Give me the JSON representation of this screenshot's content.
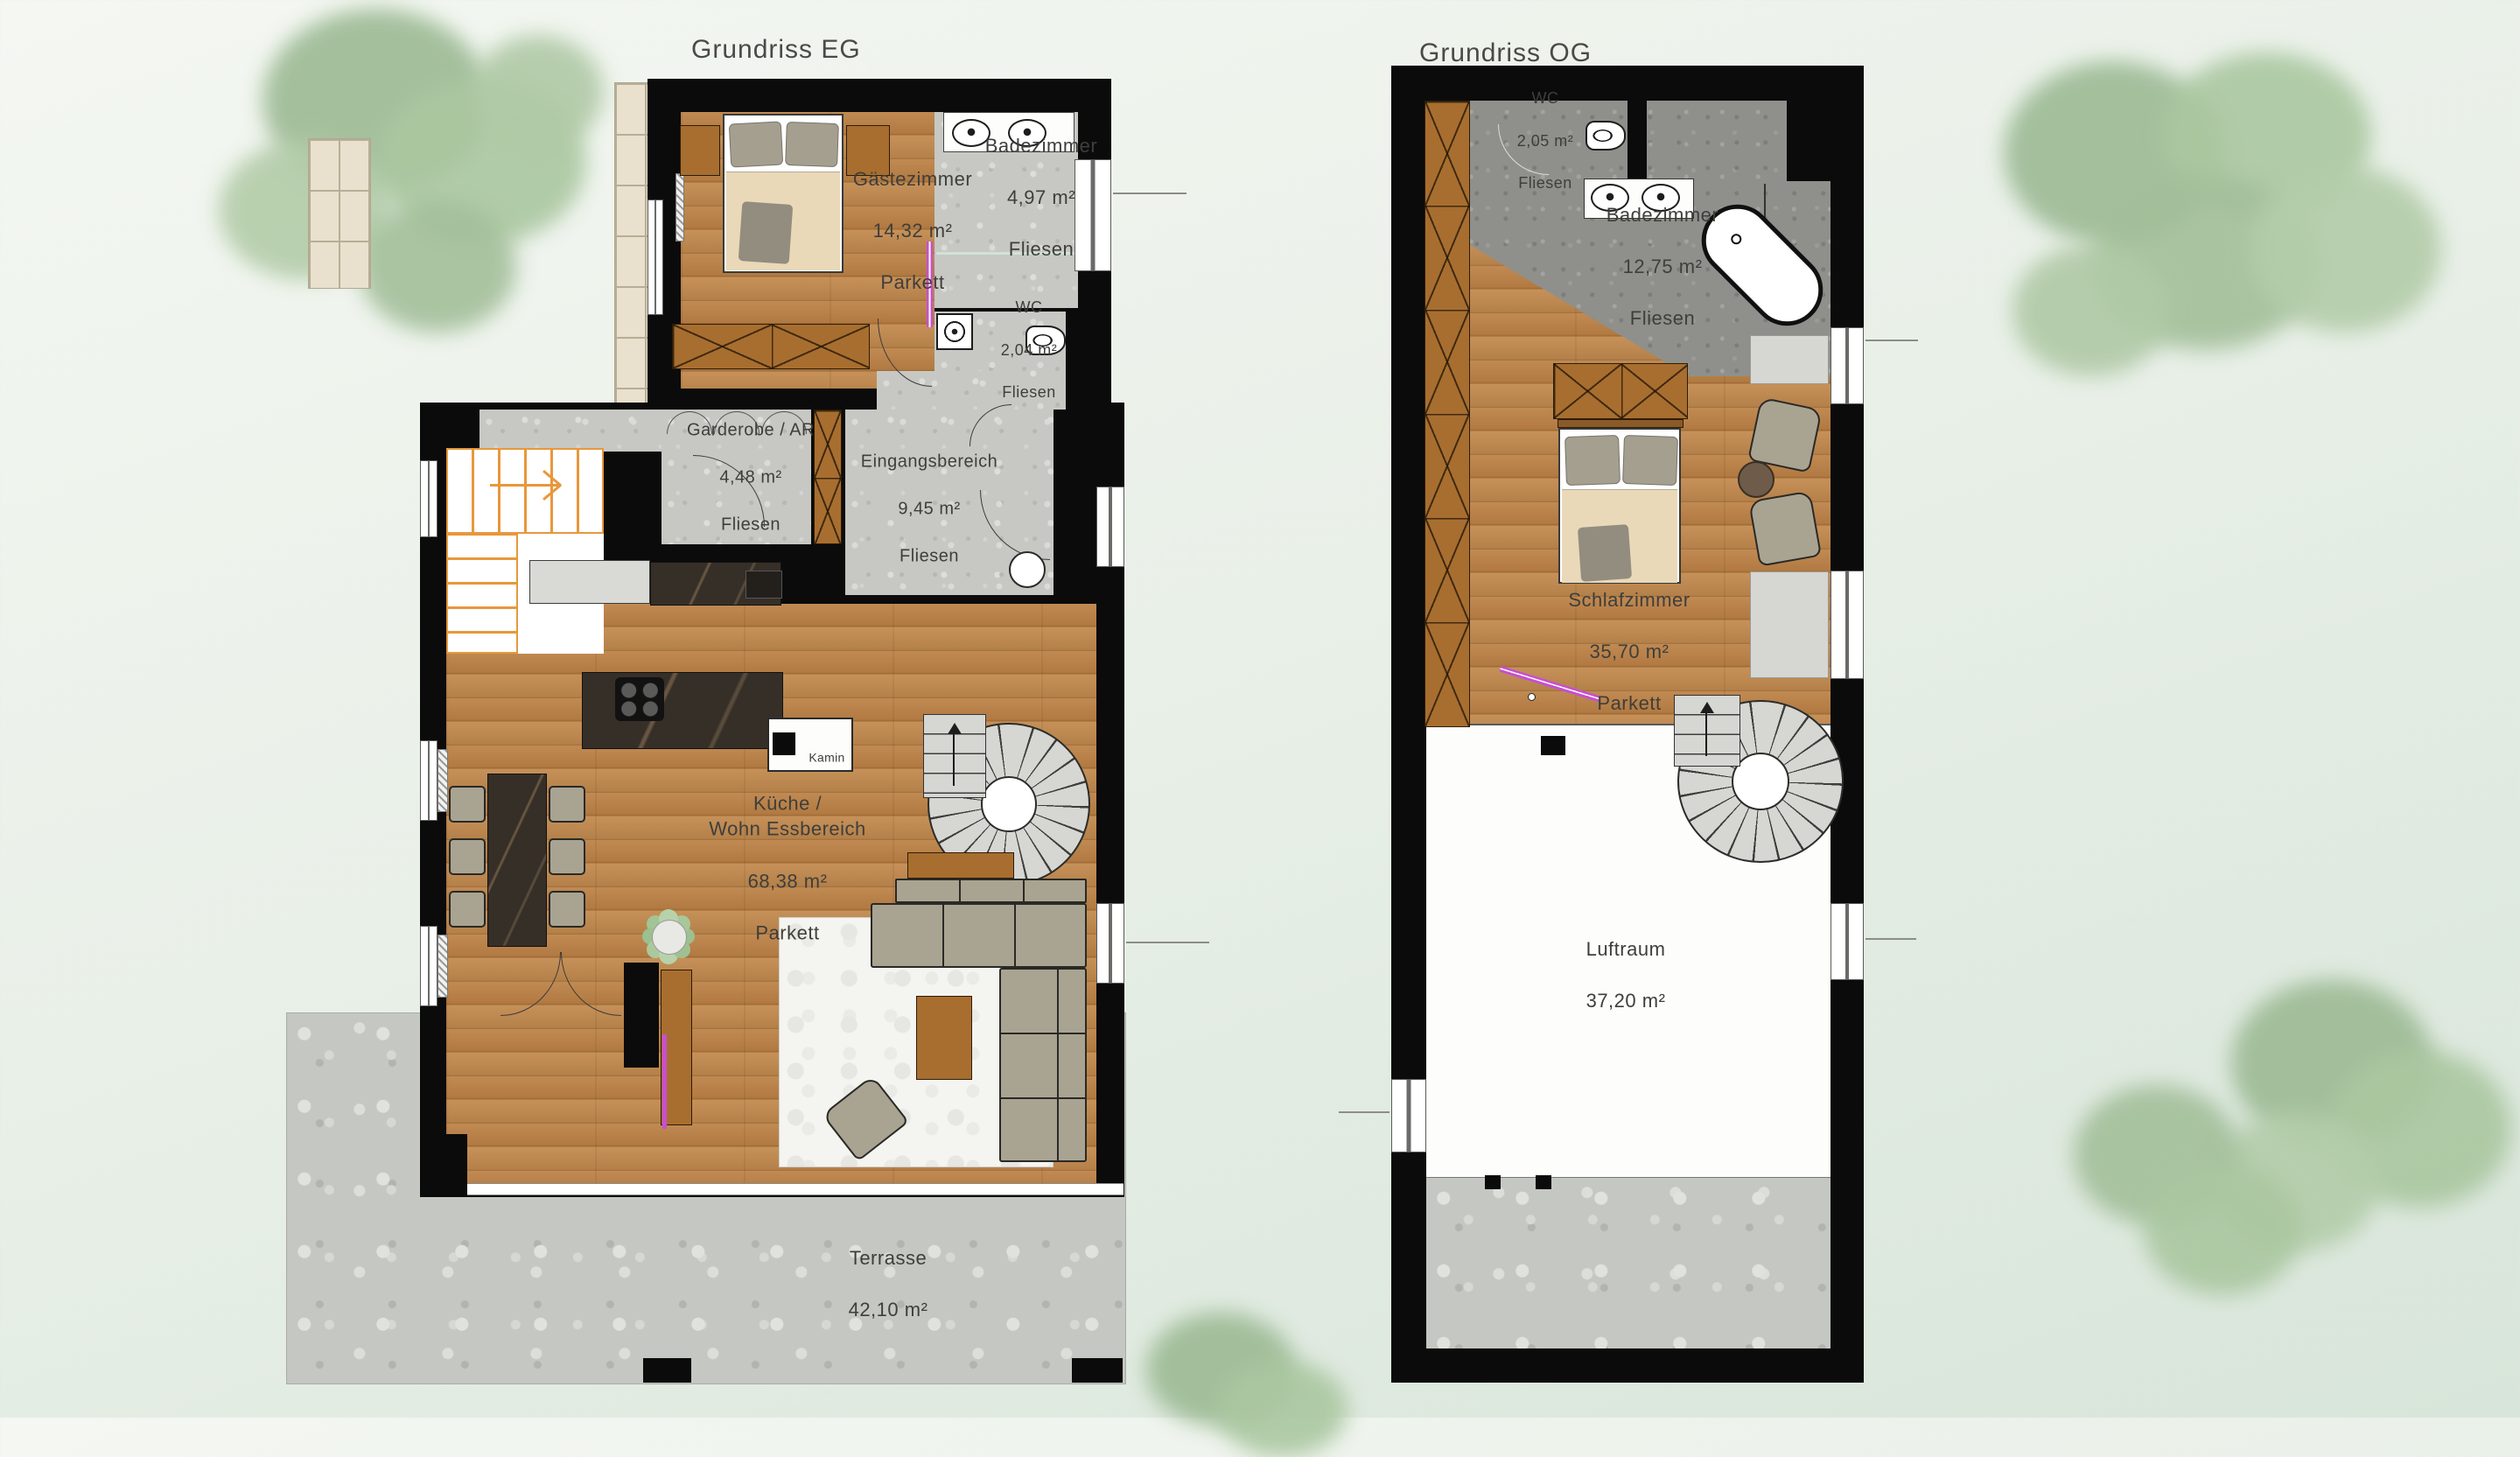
{
  "app": {
    "type": "architectural floor plan drawing"
  },
  "plans": {
    "eg": {
      "title": "Grundriss EG",
      "rooms": {
        "gaestezimmer": {
          "name": "Gästezimmer",
          "area": "14,32 m²",
          "floor": "Parkett"
        },
        "badezimmer": {
          "name": "Badezimmer",
          "area": "4,97 m²",
          "floor": "Fliesen"
        },
        "wc": {
          "name": "WC",
          "area": "2,04 m²",
          "floor": "Fliesen"
        },
        "garderobe": {
          "name": "Garderobe / AR",
          "area": "4,48 m²",
          "floor": "Fliesen"
        },
        "eingang": {
          "name": "Eingangsbereich",
          "area": "9,45 m²",
          "floor": "Fliesen"
        },
        "kueche": {
          "name": "Küche /\nWohn Essbereich",
          "area": "68,38 m²",
          "floor": "Parkett"
        },
        "terrasse": {
          "name": "Terrasse",
          "area": "42,10 m²"
        }
      },
      "fireplace_label": "Kamin"
    },
    "og": {
      "title": "Grundriss OG",
      "rooms": {
        "wc": {
          "name": "WC",
          "area": "2,05 m²",
          "floor": "Fliesen"
        },
        "badezimmer": {
          "name": "Badezimmer",
          "area": "12,75 m²",
          "floor": "Fliesen"
        },
        "schlafzimmer": {
          "name": "Schlafzimmer",
          "area": "35,70 m²",
          "floor": "Parkett"
        },
        "luftraum": {
          "name": "Luftraum",
          "area": "37,20 m²"
        }
      }
    }
  },
  "colors": {
    "wall": "#0b0b0b",
    "wood_floor": "#b5814a",
    "tile_light": "#c7c8c3",
    "tile_dark": "#8f908b",
    "terrace": "#c5c7c2",
    "furniture_olive": "#a9a492",
    "furniture_brown": "#a86e2f",
    "counter_dark": "#362f28",
    "stair_orange": "#e8973c",
    "stair_gray": "#d6d6d3",
    "annotation_magenta": "#c84fd0",
    "tree_green": "#a3c29b",
    "background": "#e7efe7",
    "label_text": "#3f3e3b"
  },
  "icons": {
    "tree-icon": "css-green-blob",
    "bed-icon": "css-rect-pillows",
    "wardrobe-icon": "css-x-box",
    "sink-icon": "css-ellipse-dot",
    "toilet-icon": "css-ellipse-ring",
    "bathtub-icon": "css-rounded-rect-45deg",
    "stairs-icon": "css-stripe-flight",
    "spiral-stairs-icon": "css-conic-fan",
    "sofa-icon": "css-olive-L",
    "dining-table-icon": "css-dark-marble-rect",
    "armchair-icon": "css-rounded-olive",
    "plant-icon": "css-leaf-dots",
    "fireplace-icon": "css-white-box-black-square",
    "cooktop-icon": "css-four-burners",
    "door-swing-icon": "css-quarter-arc",
    "window-icon": "css-white-slot",
    "radiator-icon": "css-hatch-strip"
  }
}
